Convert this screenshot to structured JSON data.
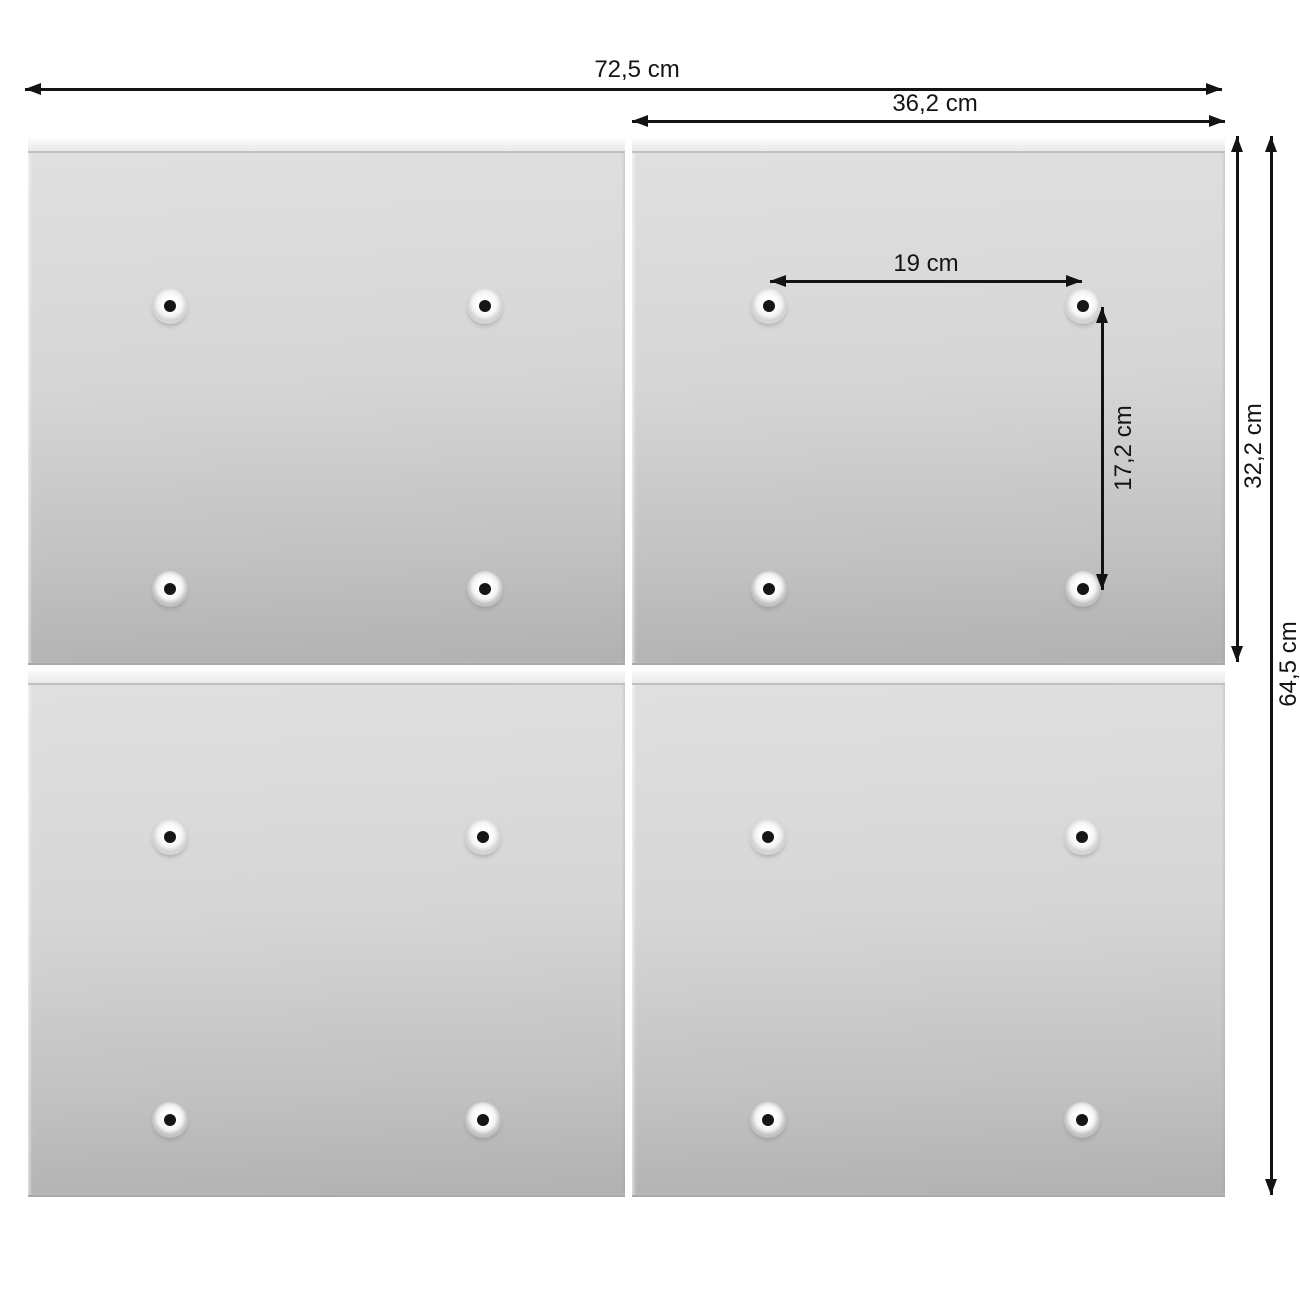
{
  "diagram": {
    "name": "four-panel splash-guard mounting dimensions",
    "unit": "cm",
    "labels": {
      "total_width": "72,5 cm",
      "panel_width": "36,2 cm",
      "hole_spacing_horizontal": "19 cm",
      "hole_spacing_vertical": "17,2 cm",
      "panel_height": "32,2 cm",
      "total_height": "64,5 cm"
    },
    "values_cm": {
      "total_width": 72.5,
      "panel_width": 36.2,
      "hole_spacing_horizontal": 19,
      "hole_spacing_vertical": 17.2,
      "panel_height": 32.2,
      "total_height": 64.5
    },
    "panels": [
      {
        "name": "top-left",
        "holes": 4
      },
      {
        "name": "top-right",
        "holes": 4
      },
      {
        "name": "bottom-left",
        "holes": 4
      },
      {
        "name": "bottom-right",
        "holes": 4
      }
    ],
    "colors": {
      "background": "#ffffff",
      "dimension_line": "#131313",
      "panel_light": "#e0e0e0",
      "panel_dark": "#b1b1b1",
      "panel_strip": "#f0f0f0",
      "hole_dot": "#161616"
    }
  }
}
